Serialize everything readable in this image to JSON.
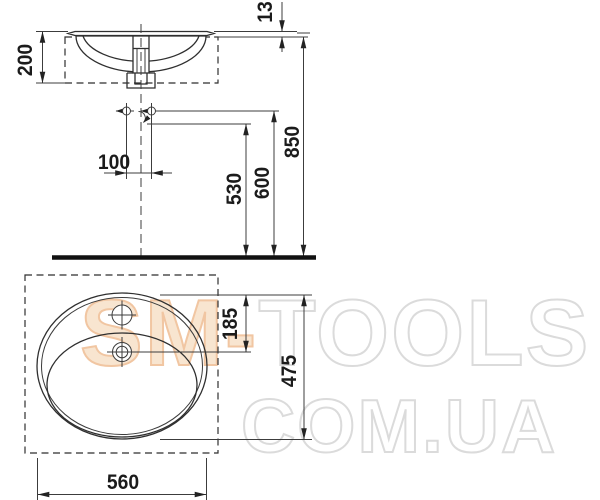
{
  "diagram": {
    "kind": "washbasin installation technical drawing",
    "views": {
      "side_view": "basin cross-section with countertop cutout, trap and connection heights",
      "plan_view": "oval basin top view with tap hole, drain and cutout"
    }
  },
  "dimensions": {
    "side": {
      "rim_above_counter": "13",
      "bowl_depth": "200",
      "counter_height": "850",
      "supply_height": "600",
      "drain_height": "530",
      "supply_spacing": "100"
    },
    "plan": {
      "drain_offset_from_back": "185",
      "overall_depth": "475",
      "overall_width": "560"
    }
  },
  "watermark": {
    "brand_accent": "SM-",
    "brand_rest": "TOOLS",
    "domain_line": "COM.UA",
    "accent_fill": "#F8E5D0",
    "accent_stroke": "#F1C6A2",
    "outline_color": "#DBDBDB"
  },
  "colors": {
    "line": "#2f2f2f",
    "floor": "#111111",
    "label": "#1b1b1b"
  }
}
